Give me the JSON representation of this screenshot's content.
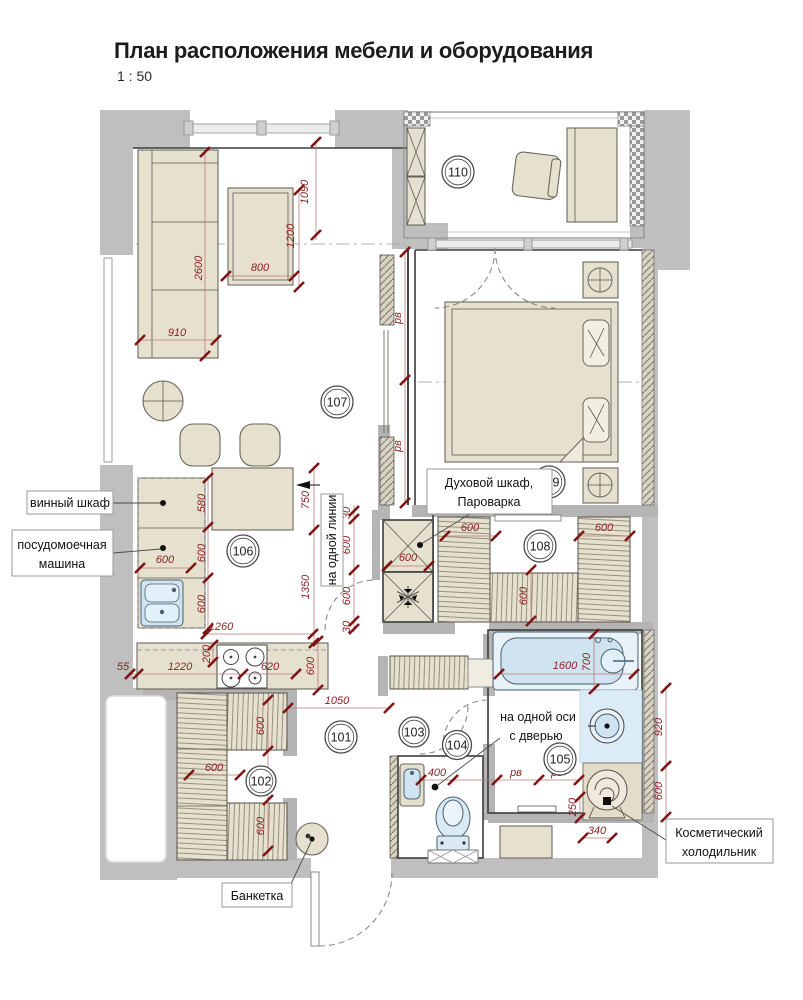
{
  "header": {
    "title": "План расположения мебели и оборудования",
    "scale": "1 : 50"
  },
  "rooms": {
    "n101": "101",
    "n102": "102",
    "n103": "103",
    "n104": "104",
    "n105": "105",
    "n106": "106",
    "n107": "107",
    "n108": "108",
    "n109": "109",
    "n110": "110"
  },
  "labels": {
    "wine": "винный шкаф",
    "dw1": "посудомоечная",
    "dw2": "машина",
    "oven1": "Духовой шкаф,",
    "oven2": "Пароварка",
    "line": "на одной линии",
    "axis1": "на одной оси",
    "axis2": "с дверью",
    "cosm1": "Косметический",
    "cosm2": "холодильник",
    "bench": "Банкетка"
  },
  "dims": {
    "d1090": "1090",
    "d1200": "1200",
    "d800": "800",
    "d2600": "2600",
    "d910": "910",
    "d580": "580",
    "d750": "750",
    "d600": "600",
    "d1350": "1350",
    "d1260": "1260",
    "d200": "200",
    "d55": "55",
    "d1220": "1220",
    "d620": "620",
    "d1050": "1050",
    "d30": "30",
    "d1600": "1600",
    "d700": "700",
    "d920": "920",
    "d250": "250",
    "d340": "340",
    "d400": "400",
    "pv": "рв"
  },
  "colors": {
    "wall_gray": "#bfbfbf",
    "furniture_beige": "#e6e0cf",
    "fixture_blue": "#cfe4f0",
    "dimension_red": "#8e2222",
    "line_black": "#3c3c3c"
  }
}
